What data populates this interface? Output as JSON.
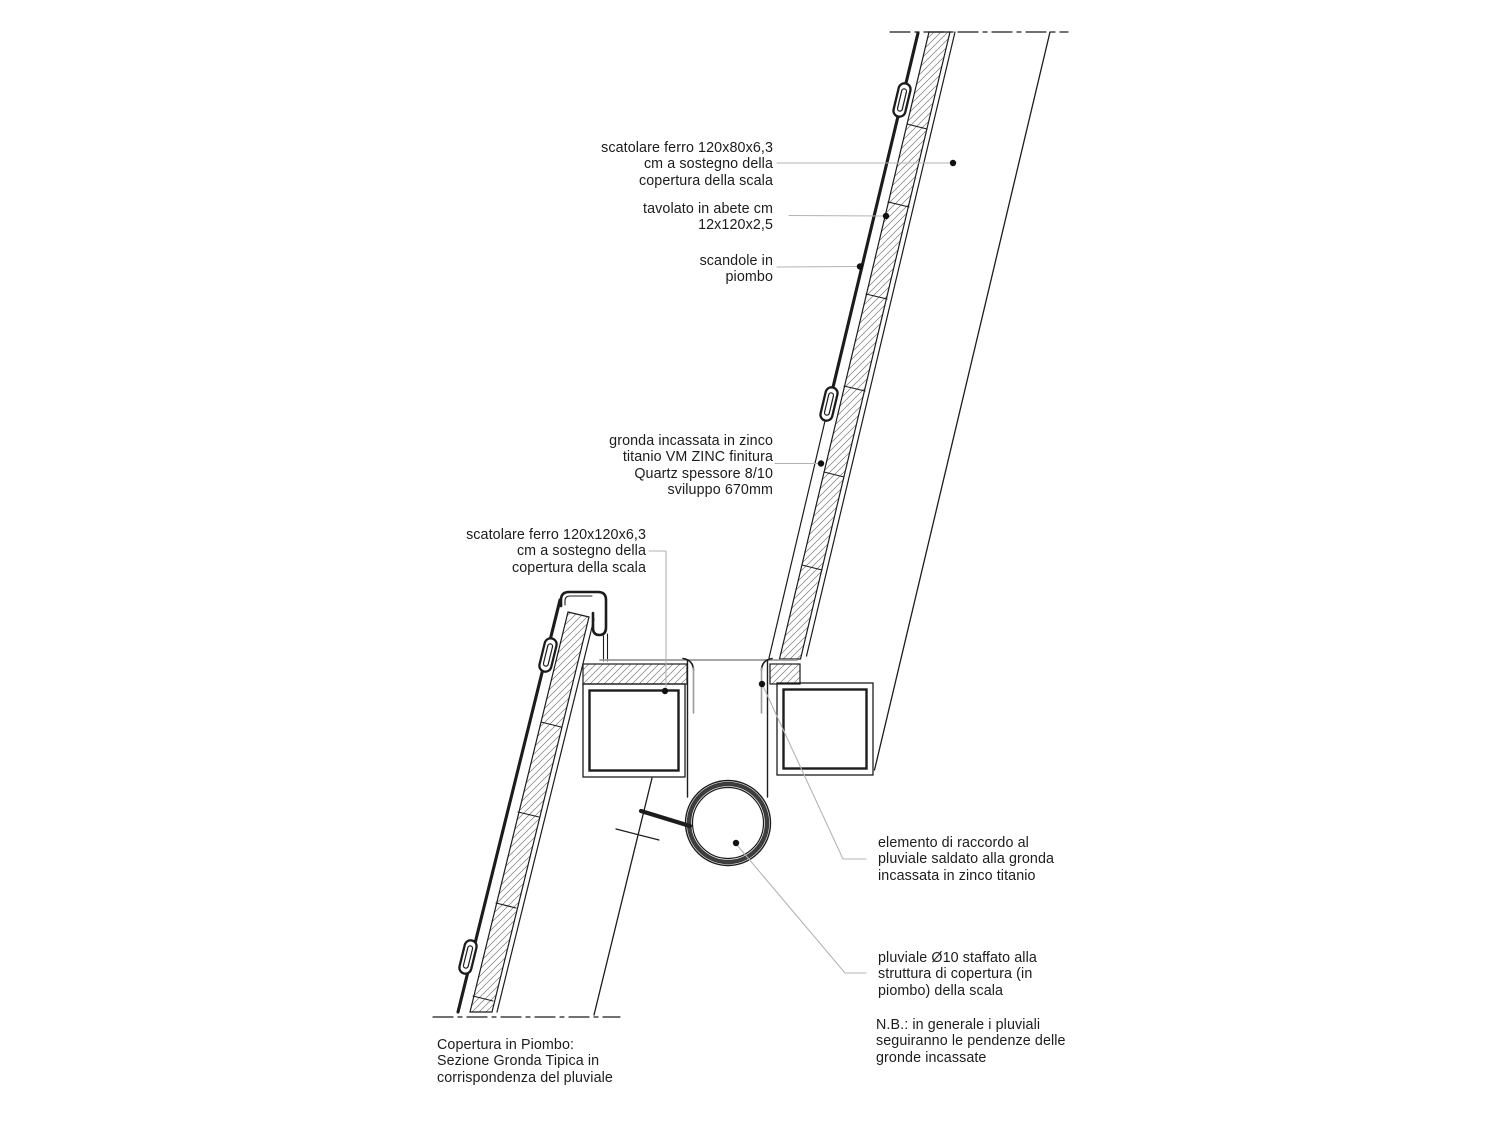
{
  "drawing": {
    "kind": "architectural-section-detail",
    "language": "it",
    "title": {
      "lines": [
        "Copertura in Piombo:",
        "Sezione Gronda Tipica in",
        "corrispondenza del pluviale"
      ]
    },
    "labels": {
      "box_steel_upper": {
        "lines": [
          "scatolare ferro 120x80x6,3",
          "cm a sostegno della",
          "copertura della scala"
        ]
      },
      "plank": {
        "lines": [
          "tavolato in abete cm",
          "12x120x2,5"
        ]
      },
      "shingles": {
        "lines": [
          "scandole in",
          "piombo"
        ]
      },
      "gutter": {
        "lines": [
          "gronda incassata in zinco",
          "titanio VM ZINC finitura",
          "Quartz spessore 8/10",
          "sviluppo 670mm"
        ]
      },
      "box_steel_lower": {
        "lines": [
          "scatolare ferro 120x120x6,3",
          "cm a sostegno della",
          "copertura della scala"
        ]
      },
      "connector": {
        "lines": [
          "elemento di raccordo al",
          "pluviale saldato alla gronda",
          "incassata in zinco titanio"
        ]
      },
      "downpipe": {
        "lines": [
          "pluviale Ø10 staffato alla",
          "struttura di copertura (in",
          "piombo) della scala"
        ]
      },
      "note": {
        "lines": [
          "N.B.: in generale i pluviali",
          "seguiranno le pendenze delle",
          "gronde incassate"
        ]
      }
    },
    "colors": {
      "ink": "#1c1c1c",
      "leader_grey": "#b3b3b3",
      "metal_grey": "#9a9a9a",
      "hatch_grey": "#787878",
      "background": "#ffffff"
    }
  }
}
